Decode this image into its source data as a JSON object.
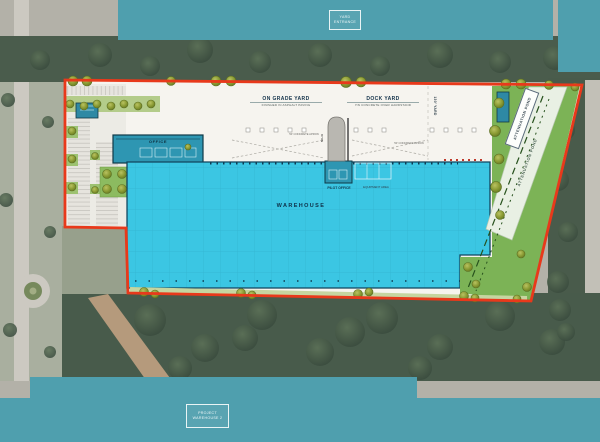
{
  "plan_type": "warehouse-site-plan-over-aerial",
  "overlays": {
    "top_box": {
      "line1": "YARD",
      "line2": "ENTRANCE"
    },
    "bottom_box": {
      "line1": "PROJECT",
      "line2": "WAREHOUSE 2"
    }
  },
  "plan": {
    "labels": {
      "on_grade_yard_title": "ON GRADE YARD",
      "on_grade_yard_sub": "FINISHED IN ASPHALT PAVING",
      "dock_yard_title": "DOCK YARD",
      "dock_yard_sub": "7IN CONCRETE OVER HARDSTAND",
      "yard_depth": "130' YARD",
      "warehouse": "WAREHOUSE",
      "office": "OFFICE",
      "pilot_office": "PILOT OFFICE",
      "equipment_area": "EQUIPMENT AREA",
      "silo": "SILO",
      "apron_left": "50' CONCRETE APRON",
      "apron_right": "50' CONCRETE APRON",
      "pond_box": "ATTENUATION POND",
      "pond_area": "ATTENUATION POND"
    },
    "colors": {
      "boundary_red": "#e8391b",
      "warehouse_cyan": "#3bc6e3",
      "office_teal": "#2e96b2",
      "landscape_green": "#7cb356",
      "redaction_teal": "#4f9fae",
      "paper": "#f6f4ef"
    }
  }
}
